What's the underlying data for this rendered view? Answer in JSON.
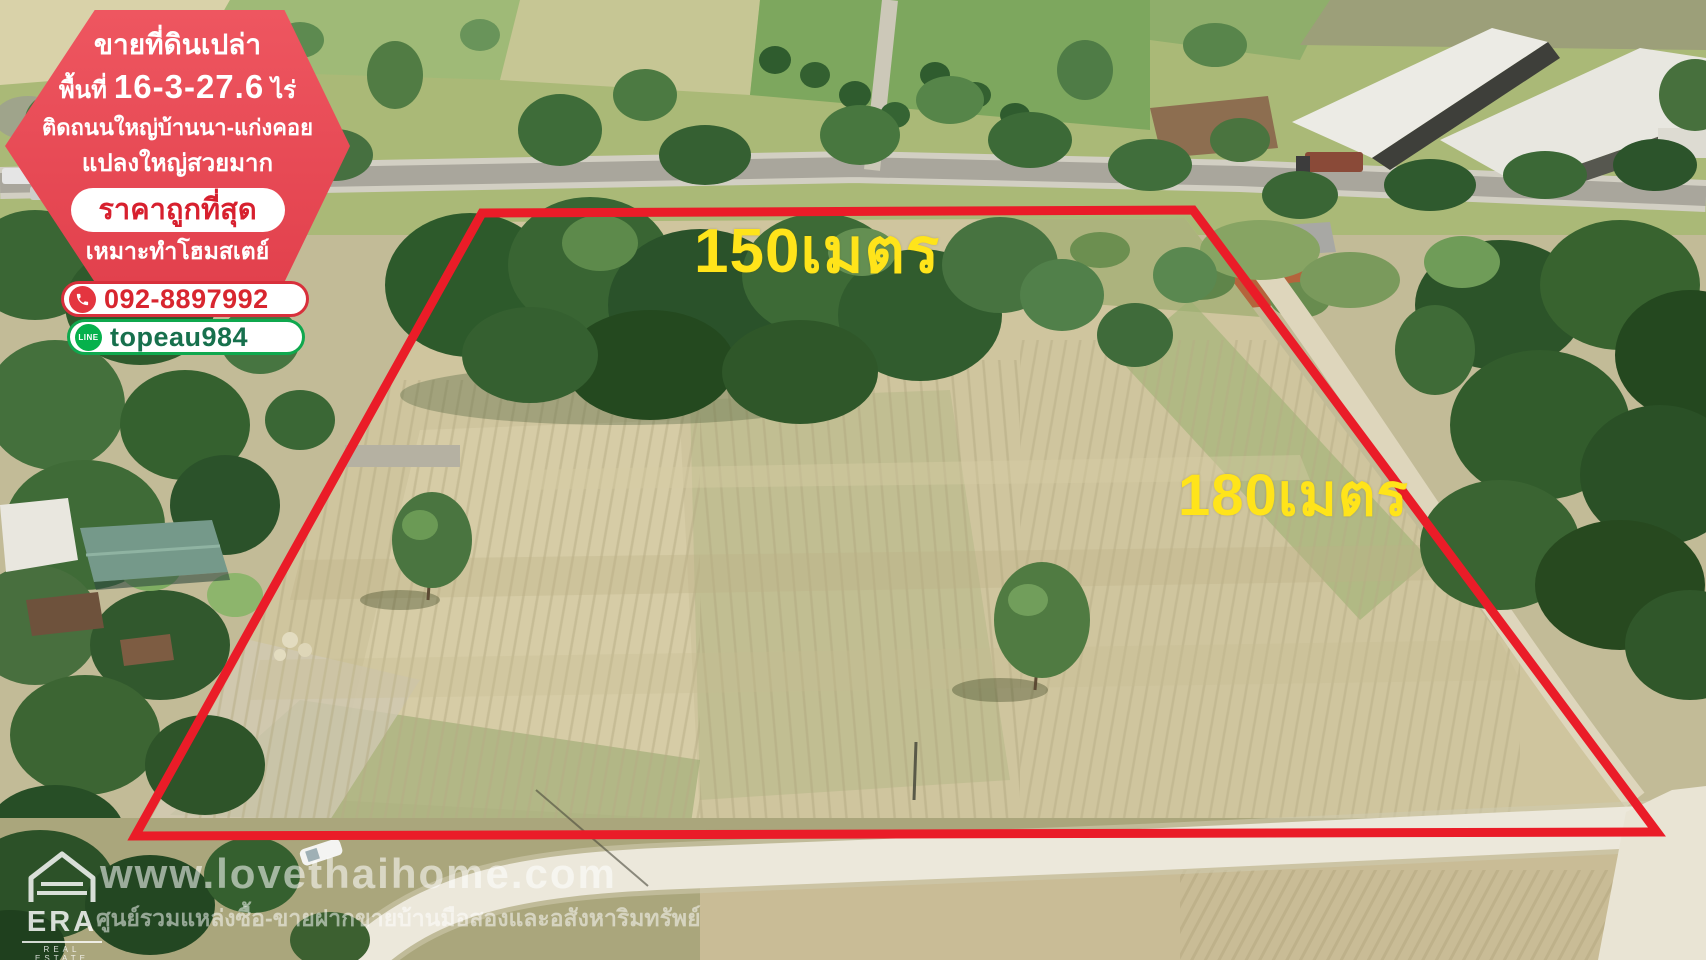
{
  "listing_badge": {
    "title": "ขายที่ดินเปล่า",
    "area_prefix": "พื้นที่",
    "area_value": "16-3-27.6",
    "area_unit": "ไร่",
    "location_line": "ติดถนนใหญ่บ้านนา-แก่งคอย",
    "plot_line": "แปลงใหญ่สวยมาก",
    "price_label": "ราคาถูกที่สุด",
    "use_line": "เหมาะทำโฮมสเตย์",
    "phone": "092-8897992",
    "line_icon_label": "LINE",
    "line_id": "topeau984",
    "colors": {
      "badge_red": "#e6505b",
      "price_text_red": "#d7202e",
      "phone_red": "#d8262f",
      "line_green": "#06b14c",
      "line_text_green": "#17704d"
    }
  },
  "dimensions": {
    "top_label": "150เมตร",
    "right_label": "180เมตร",
    "text_color": "#ffe41a",
    "boundary_color": "#ea1c28"
  },
  "watermark": {
    "url": "www.lovethaihome.com",
    "tagline": "ศูนย์รวมแหล่งซื้อ-ขายฝากขายบ้านมือสองและอสังหาริมทรัพย์"
  },
  "era": {
    "brand": "ERA",
    "sub": "REAL ESTATE"
  }
}
